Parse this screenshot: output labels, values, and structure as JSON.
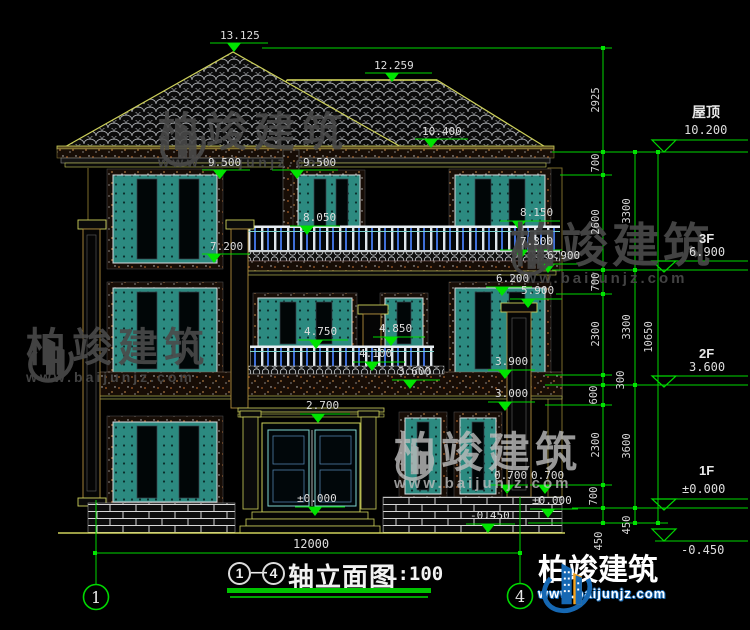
{
  "drawing": {
    "title": {
      "axis_start": "1",
      "axis_end": "4",
      "dash": "—",
      "name": "轴立面图",
      "scale": "1:100"
    },
    "axis_bubbles": {
      "left": "1",
      "right": "4"
    },
    "overall_width_dim": "12000",
    "levels": {
      "roof": {
        "label": "屋顶",
        "elev": "10.200"
      },
      "f3": {
        "label": "3F",
        "elev": "6.900"
      },
      "f2": {
        "label": "2F",
        "elev": "3.600"
      },
      "f1": {
        "label": "1F",
        "elev": "±0.000"
      },
      "ground": {
        "elev": "-0.450"
      }
    },
    "marks": {
      "m1": "13.125",
      "m2": "12.259",
      "m3": "10.400",
      "m4": "9.500",
      "m5": "9.500",
      "m6": "8.050",
      "m7": "7.200",
      "m8": "8.150",
      "m9": "7.300",
      "m10": "6.900",
      "m11": "6.200",
      "m12": "5.900",
      "m13": "4.750",
      "m14": "4.850",
      "m15": "4.100",
      "m16": "3.600",
      "m17": "3.900",
      "m18": "3.000",
      "m19": "2.700",
      "m20": "0.700",
      "m21": "0.700",
      "m22": "±0.000",
      "m23": "±0.000",
      "m24": "-0.450"
    },
    "dims_inner": [
      "2925",
      "700",
      "2600",
      "700",
      "2300",
      "300",
      "600",
      "2300",
      "700",
      "450"
    ],
    "dims_floor": [
      "3300",
      "3300",
      "3600",
      "450"
    ],
    "dim_total": "10650"
  },
  "watermark": {
    "name": "柏竣建筑",
    "url": "www.baijunjz.com"
  },
  "colors": {
    "annotation_green": "#00d800",
    "line_yellow": "#cdd05a",
    "window_teal": "#2c8a80",
    "logo_blue": "#1668b3",
    "logo_orange": "#f5a21b",
    "background": "#000000"
  }
}
